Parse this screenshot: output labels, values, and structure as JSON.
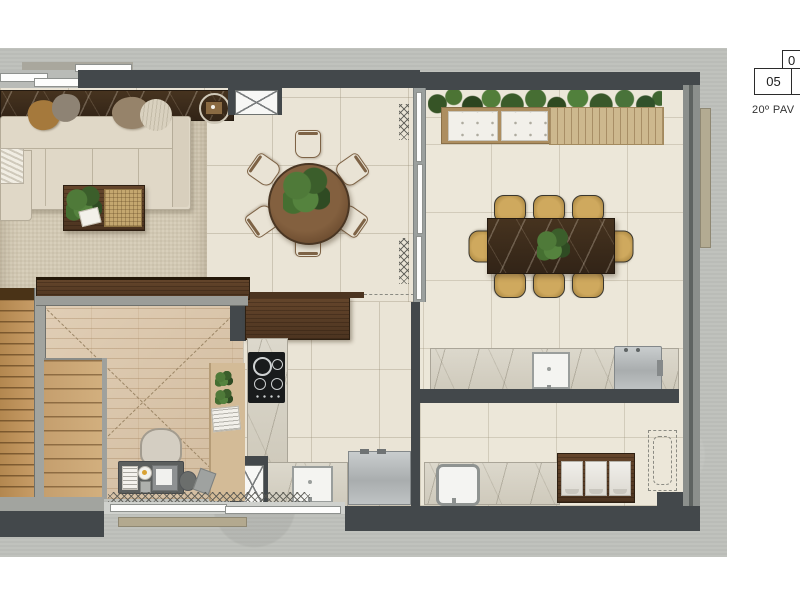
{
  "keyplan": {
    "floor_label": "20º PAV",
    "current_unit": "05",
    "partial_unit_top": "0"
  },
  "colors": {
    "wall": "#43484b",
    "concrete": "#bec0bb",
    "floor_tile": "#eae4d6",
    "terrace_tile": "#ece7d9",
    "wood_floor": "#dcc7ab",
    "rug": "#d8cfbb",
    "sofa": "#e0d8c7",
    "walnut": "#5d4126",
    "dark_marble": "#3b2b1e",
    "light_marble": "#dad6ca",
    "deck": "#cdb88e",
    "plant_green": "#4c7538",
    "chair_tan": "#c9a55c",
    "stainless": "#b9bdbe"
  }
}
